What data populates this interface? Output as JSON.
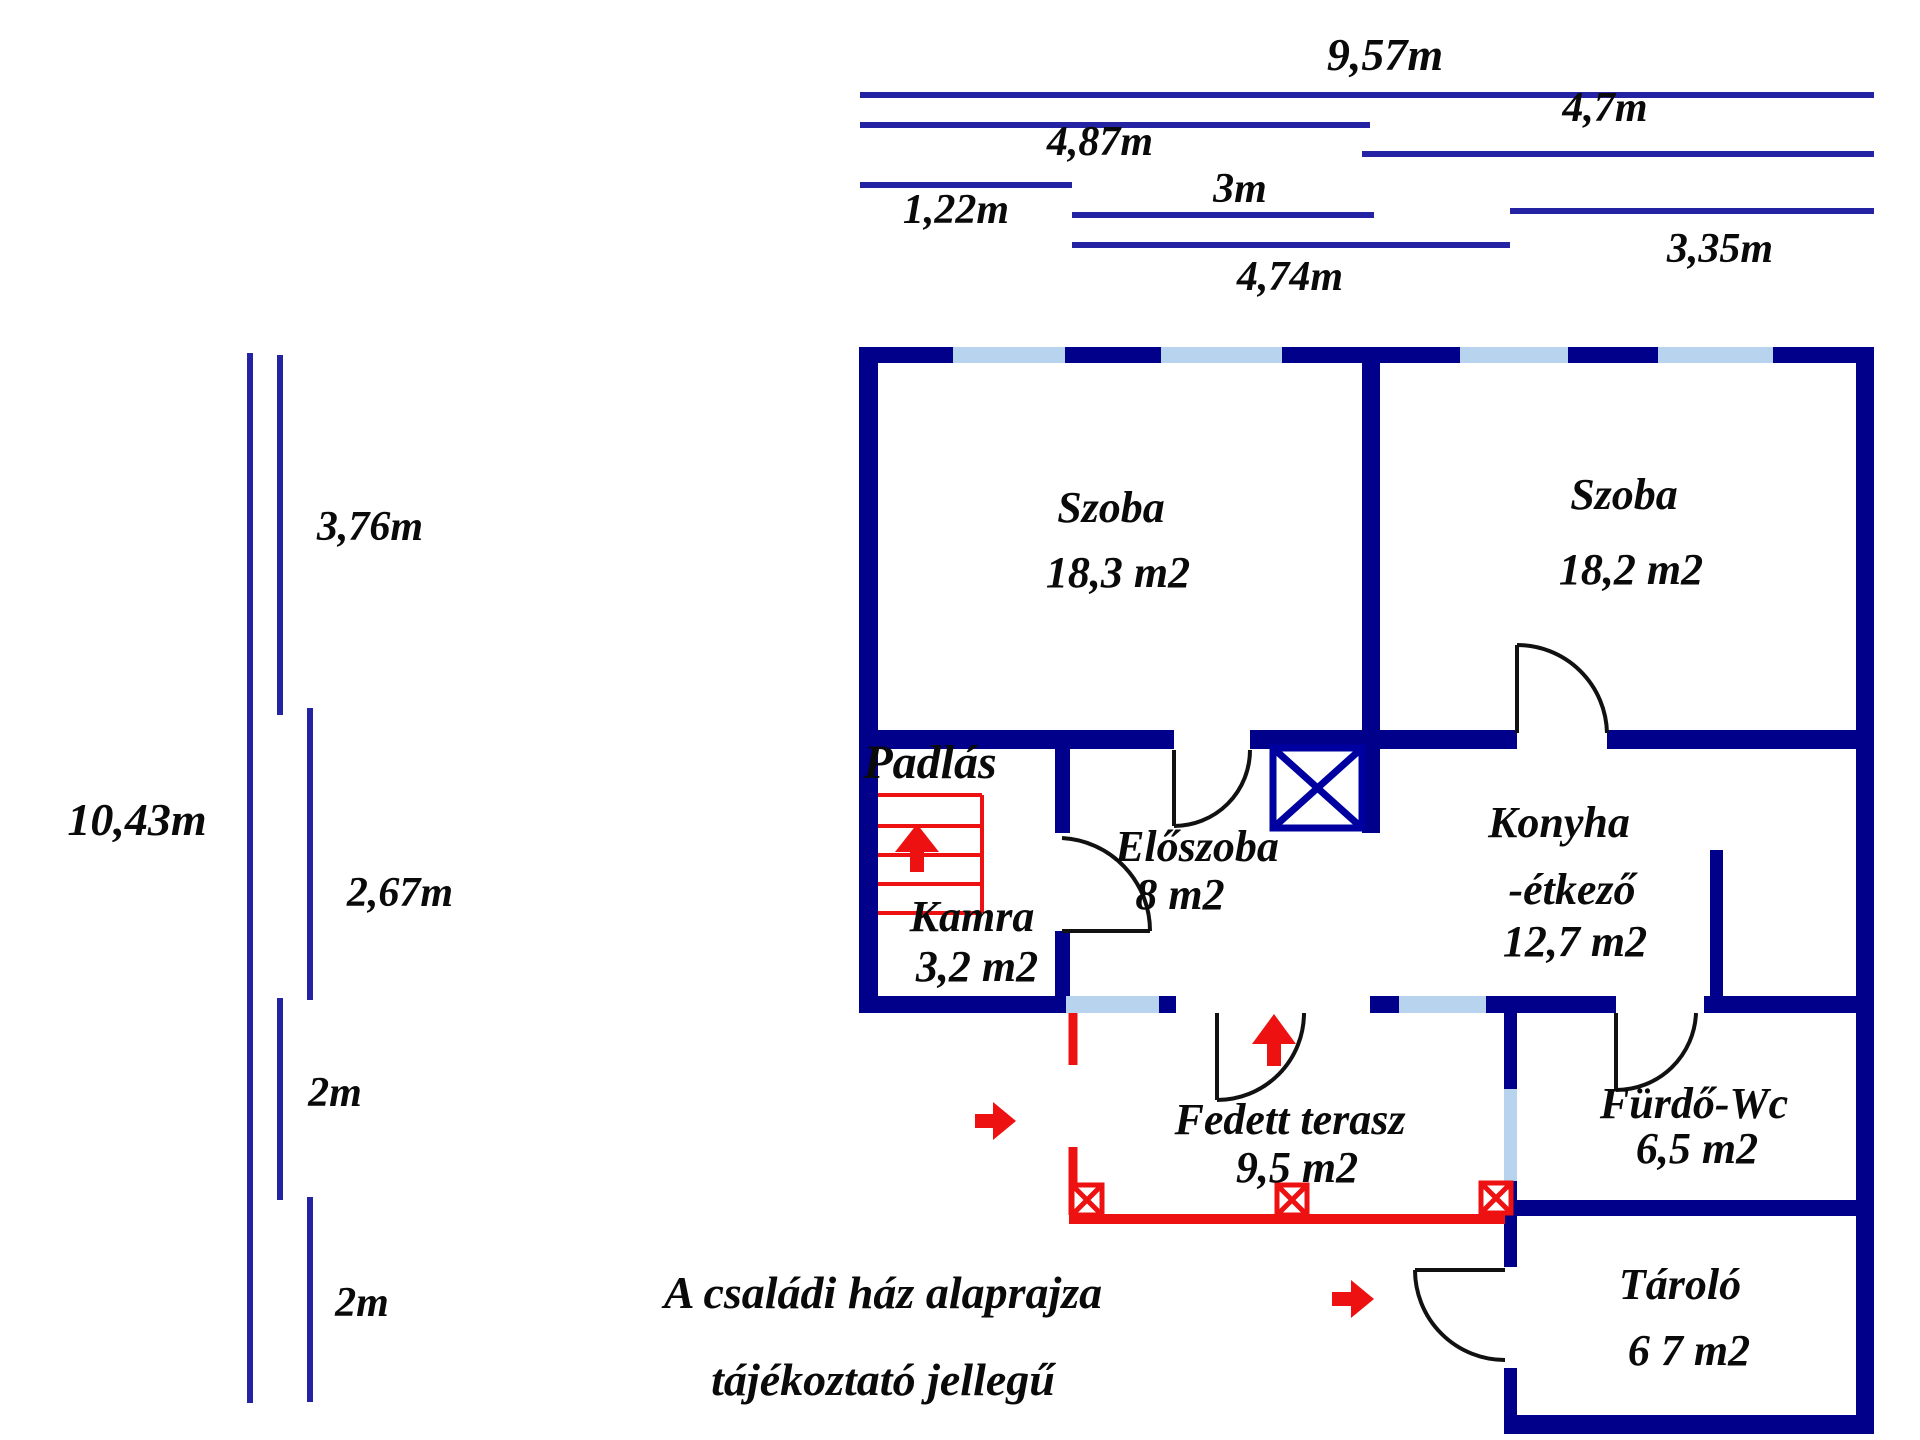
{
  "colors": {
    "wall": "#00008b",
    "dimension_line": "#2323a3",
    "window_fill": "#b7d3ee",
    "red_marking": "#ee1111",
    "text": "#0a0a0a"
  },
  "dimensions_top": {
    "total_width": "9,57m",
    "left_section": "4,87m",
    "right_section": "4,7m",
    "small_left": "1,22m",
    "middle": "3m",
    "terrace": "4,74m",
    "right_lower": "3,35m"
  },
  "dimensions_left": {
    "total_height": "10,43m",
    "seg1": "3,76m",
    "seg2": "2,67m",
    "seg3": "2m",
    "seg4": "2m"
  },
  "rooms": [
    {
      "name": "Szoba",
      "area": "18,3 m2"
    },
    {
      "name": "Szoba",
      "area": "18,2 m2"
    },
    {
      "name": "Padlás",
      "area": ""
    },
    {
      "name": "Kamra",
      "area": "3,2 m2"
    },
    {
      "name": "Előszoba",
      "area": "8 m2"
    },
    {
      "name": "Konyha",
      "name2": "-étkező",
      "area": "12,7 m2"
    },
    {
      "name": "Fedett terasz",
      "area": "9,5 m2"
    },
    {
      "name": "Fürdő-Wc",
      "area": "6,5 m2"
    },
    {
      "name": "Tároló",
      "area": "6 7 m2"
    }
  ],
  "caption": {
    "line1": "A családi ház alaprajza",
    "line2": "tájékoztató jellegű"
  }
}
